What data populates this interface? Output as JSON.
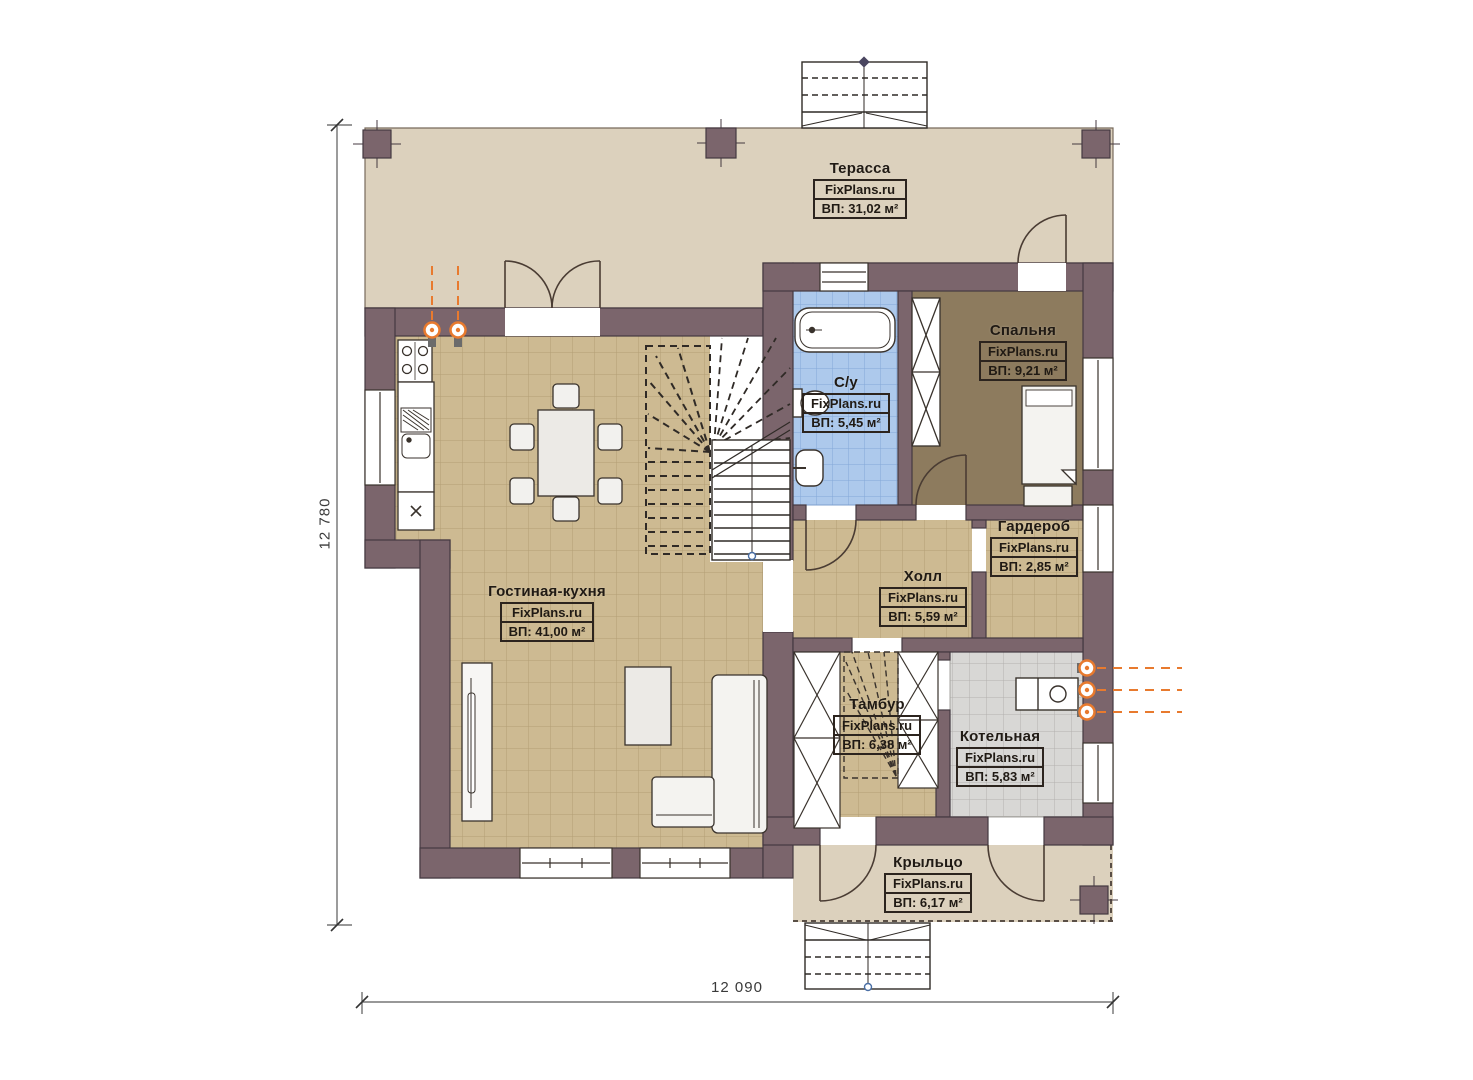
{
  "plan": {
    "brand": "FixPlans.ru",
    "rooms": [
      {
        "name": "Терасса",
        "area": "ВП: 31,02 м²"
      },
      {
        "name": "Спальня",
        "area": "ВП: 9,21 м²"
      },
      {
        "name": "С/у",
        "area": "ВП: 5,45 м²"
      },
      {
        "name": "Гардероб",
        "area": "ВП: 2,85 м²"
      },
      {
        "name": "Холл",
        "area": "ВП: 5,59 м²"
      },
      {
        "name": "Гостиная-кухня",
        "area": "ВП: 41,00 м²"
      },
      {
        "name": "Тамбур",
        "area": "ВП: 6,38 м²"
      },
      {
        "name": "Котельная",
        "area": "ВП: 5,83 м²"
      },
      {
        "name": "Крыльцо",
        "area": "ВП: 6,17 м²"
      }
    ],
    "dimensions": {
      "height": "12 780",
      "width": "12 090"
    },
    "colors": {
      "wall": "#7b656c",
      "terrace_floor": "#dcd1bd",
      "tile_floor": "#cdba92",
      "bath_floor": "#adc9ec",
      "boiler_floor": "#d8d7d5",
      "bedroom_floor": "#8d7b5e",
      "utility_accent": "#e87a2e"
    }
  }
}
